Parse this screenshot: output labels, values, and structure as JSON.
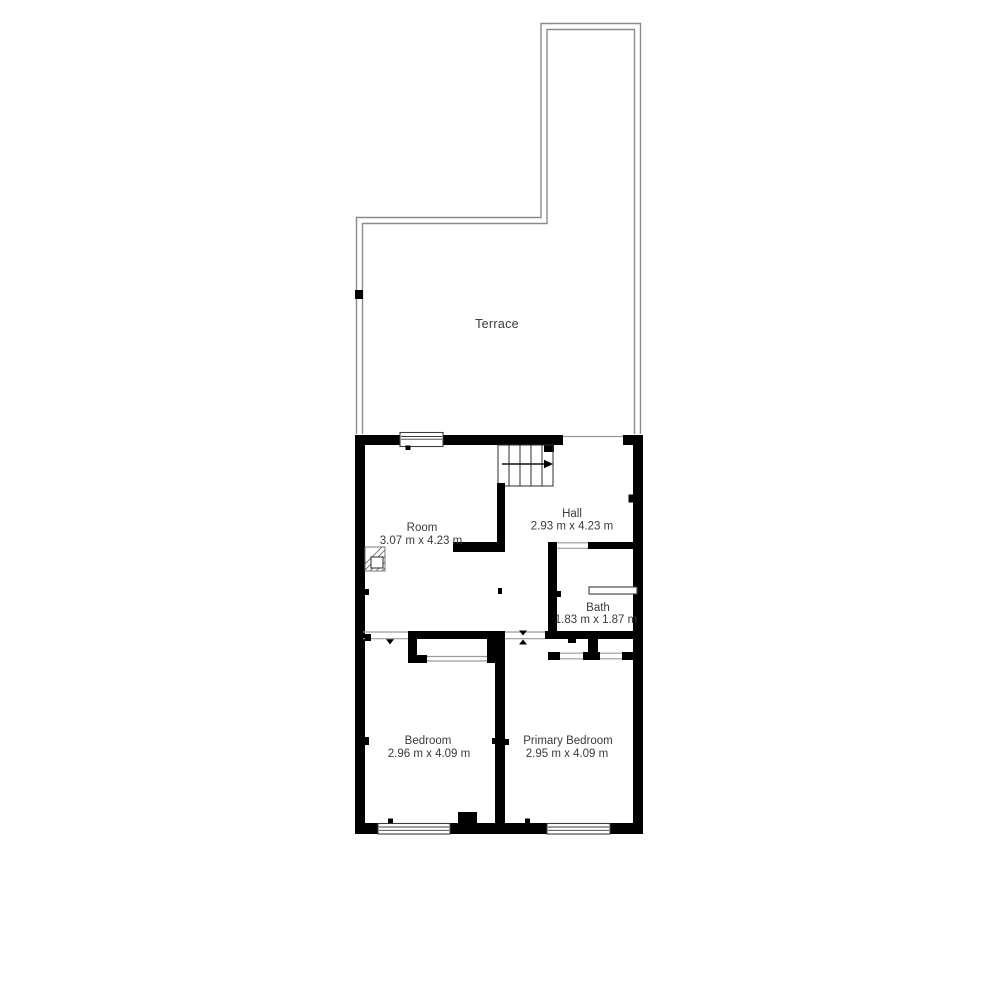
{
  "plan": {
    "type": "floor-plan",
    "rooms": {
      "terrace": {
        "name": "Terrace",
        "dims": ""
      },
      "room": {
        "name": "Room",
        "dims": "3.07 m x 4.23 m"
      },
      "hall": {
        "name": "Hall",
        "dims": "2.93 m x 4.23 m"
      },
      "bath": {
        "name": "Bath",
        "dims": "1.83 m x 1.87 m"
      },
      "bedroom": {
        "name": "Bedroom",
        "dims": "2.96 m x 4.09 m"
      },
      "primary_bedroom": {
        "name": "Primary Bedroom",
        "dims": "2.95 m x 4.09 m"
      }
    },
    "colors": {
      "wall": "#000000",
      "terrace_outline": "#8b8b8b",
      "text": "#3a3a3a",
      "background": "#ffffff"
    }
  }
}
